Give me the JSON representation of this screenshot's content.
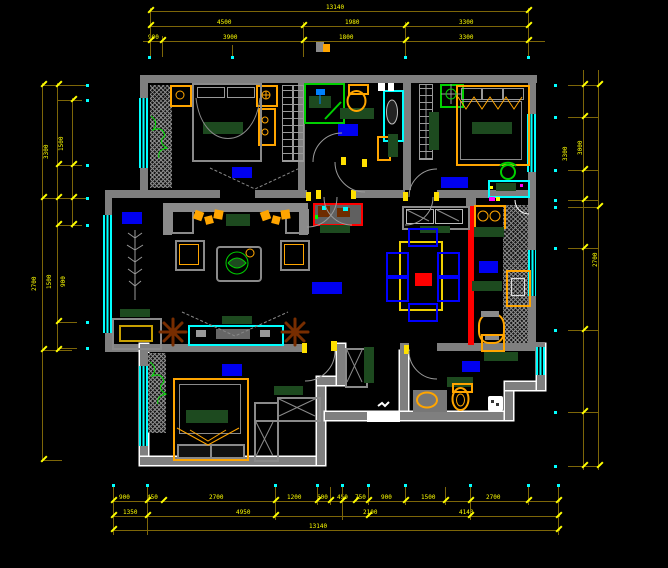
{
  "drawing": {
    "kind": "apartment floor plan",
    "style": "CAD blueprint, white/gray walls on black with yellow dimension chains"
  },
  "palette": {
    "background": "#000000",
    "wall": "#7f7f7f",
    "wall_outline": "#ffffff",
    "window": "#00ffff",
    "dimension_line": "#7d6608",
    "dimension_text": "#ffff00",
    "room_label": "#0000f0",
    "furniture_accent": "#ffa500",
    "dark_green": "#1d4a1f",
    "bright_green": "#00d000",
    "highlight_red": "#ff0000",
    "chair_blue": "#0000ff",
    "plant_brown": "#6e2c00",
    "magenta_dot": "#ff00ff"
  },
  "dims": {
    "top1": [
      "13140"
    ],
    "top2": [
      "4500",
      "1980",
      "3300"
    ],
    "top3": [
      "900",
      "3900",
      "1800",
      "3300"
    ],
    "bottom1": [
      "900",
      "450",
      "2700",
      "1200",
      "600",
      "450",
      "750",
      "900",
      "1500",
      "2700"
    ],
    "bottom2": [
      "1350",
      "4950",
      "2100",
      "4140"
    ],
    "bottom3": [
      "13140"
    ],
    "left": [
      "3300",
      "1500",
      "2700",
      "1500",
      "900"
    ],
    "right": [
      "3300",
      "3000",
      "2700"
    ]
  }
}
